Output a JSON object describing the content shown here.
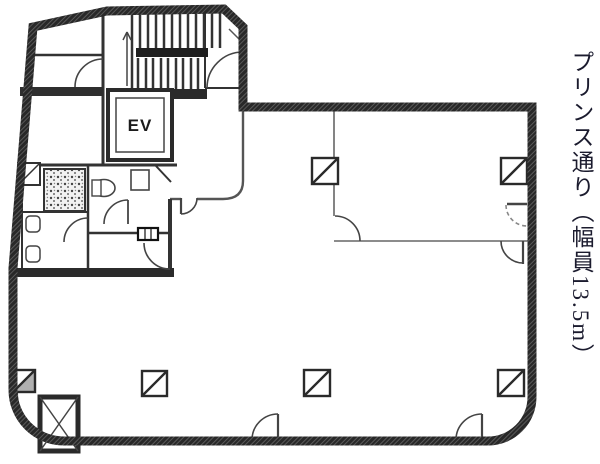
{
  "plan": {
    "elevator_label": "EV",
    "street_label": "プリンス通り（幅員13.5m）"
  },
  "colors": {
    "background": "#ffffff",
    "exterior_wall": "#282828",
    "interior_wall": "#333333",
    "thin_partition": "#666666",
    "door_arc": "#444444",
    "label_text": "#1b1b2e"
  }
}
